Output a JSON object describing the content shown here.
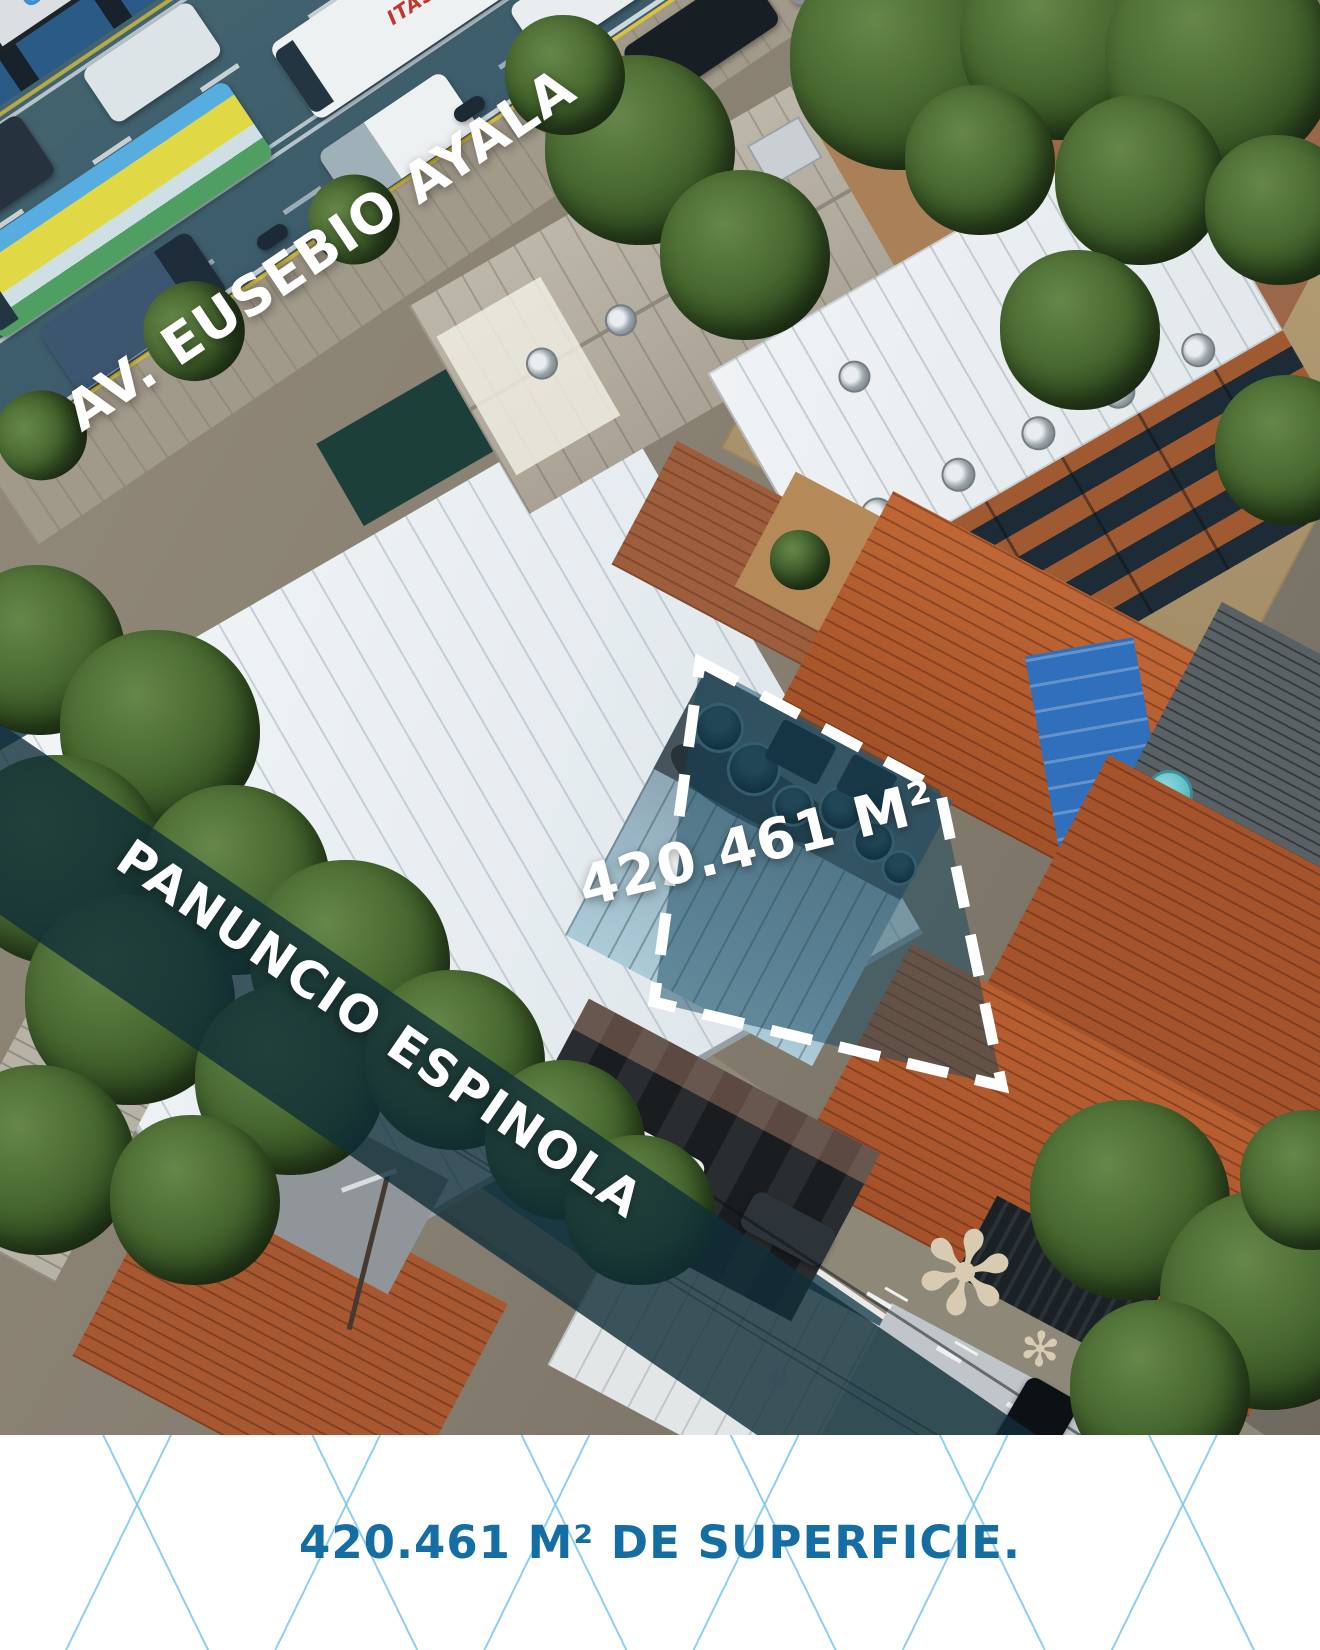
{
  "photo": {
    "avenue_label": "AV. EUSEBIO AYALA",
    "street_label": "PANUNCIO ESPINOLA",
    "area_label": "420.461 M²",
    "storefront_sign": "cmyk",
    "bus_livery": "ITASA"
  },
  "caption": {
    "text": "420.461 M² DE SUPERFICIE."
  },
  "colors": {
    "caption_text": "#146da3",
    "caption_lines": "#7cc7ee",
    "street_overlay_band": "rgba(16,46,56,0.8)",
    "parcel_fill": "rgba(21,72,94,0.5)",
    "parcel_outline": "#ffffff",
    "overlay_label_text": "#ffffff"
  }
}
